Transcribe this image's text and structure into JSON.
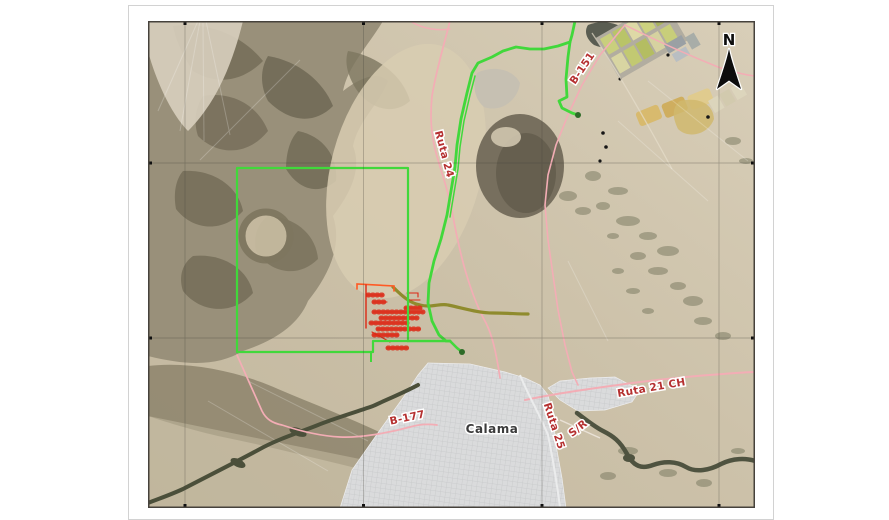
{
  "map": {
    "road_labels": [
      {
        "id": "ruta24",
        "text": "Ruta 24"
      },
      {
        "id": "b151",
        "text": "B-151"
      },
      {
        "id": "ruta21ch",
        "text": "Ruta 21 CH"
      },
      {
        "id": "ruta25",
        "text": "Ruta 25"
      },
      {
        "id": "sr",
        "text": "S/R"
      },
      {
        "id": "b177",
        "text": "B-177"
      }
    ],
    "city_label": "Calama",
    "north_indicator": "N",
    "colors": {
      "road_label_red": "#b53030",
      "city_label_gray": "#3b3b3b",
      "route_green": "#41d83b",
      "concession_boundary_green": "#41d83b",
      "road_pink": "#f3adb5",
      "road_olive": "#8f8b2d",
      "drill_grid_red": "#dd2815",
      "drill_grid_orange": "#ff5a24",
      "desert_tan": "#cdc2aa",
      "city_fill": "#dadbdc",
      "river_dark": "#4f5340"
    }
  }
}
